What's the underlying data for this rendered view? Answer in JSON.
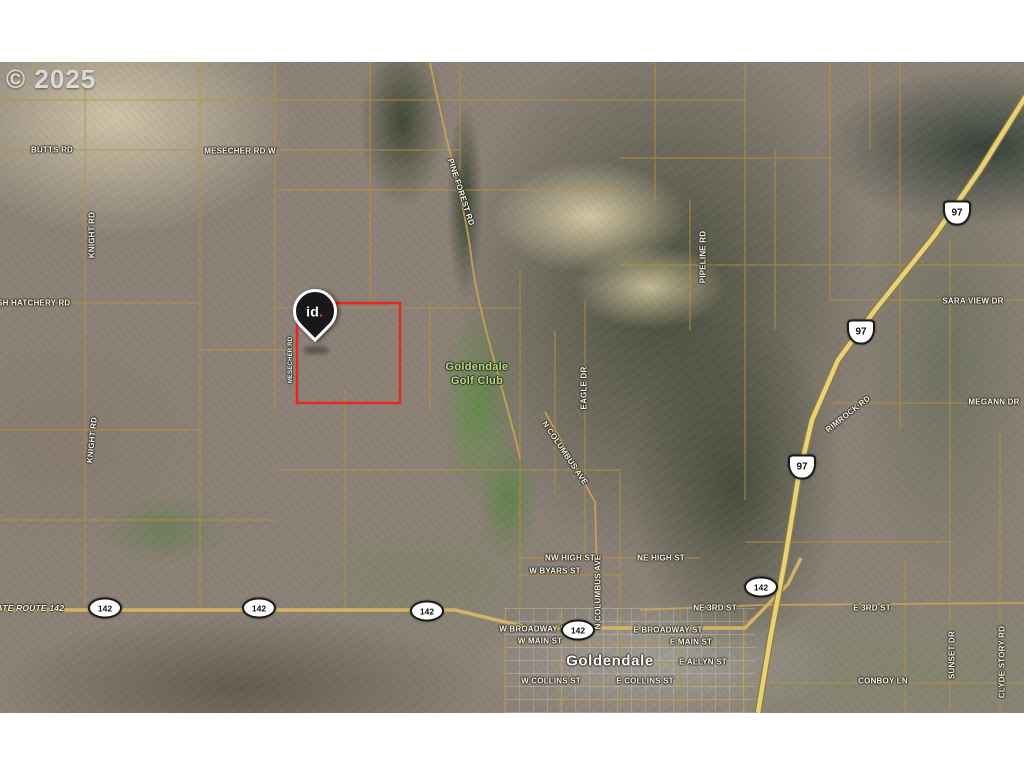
{
  "copyright": "© 2025",
  "pin": {
    "label": "id",
    "dot": "."
  },
  "colors": {
    "boundary_red": "#e8271e",
    "parcel_orange": "#bb8f40",
    "highway_yellow": "#e6d27c",
    "pin_dot_red": "#e8392e",
    "label_green": "#b6d97c"
  },
  "map": {
    "labels": [
      {
        "text": "BUTTS RD",
        "x": 52,
        "y": 88,
        "rot": 0,
        "kind": "road"
      },
      {
        "text": "MESECHER RD W",
        "x": 240,
        "y": 89,
        "rot": 0,
        "kind": "road"
      },
      {
        "text": "KNIGHT RD",
        "x": 92,
        "y": 173,
        "rot": -90,
        "kind": "road"
      },
      {
        "text": "FISH HATCHERY RD",
        "x": 30,
        "y": 241,
        "rot": 0,
        "kind": "road"
      },
      {
        "text": "KNIGHT RD",
        "x": 92,
        "y": 378,
        "rot": -84,
        "kind": "road"
      },
      {
        "text": "MESECHER RD",
        "x": 291,
        "y": 298,
        "rot": -90,
        "kind": "small"
      },
      {
        "text": "PINE FOREST RD",
        "x": 461,
        "y": 130,
        "rot": 72,
        "kind": "road"
      },
      {
        "text": "PIPELINE RD",
        "x": 703,
        "y": 195,
        "rot": -90,
        "kind": "road"
      },
      {
        "text": "SARA VIEW DR",
        "x": 973,
        "y": 239,
        "rot": 0,
        "kind": "road"
      },
      {
        "text": "MEGANN DR",
        "x": 994,
        "y": 340,
        "rot": 0,
        "kind": "road"
      },
      {
        "text": "RIMROCK RD",
        "x": 848,
        "y": 352,
        "rot": -38,
        "kind": "road"
      },
      {
        "text": "EAGLE DR",
        "x": 584,
        "y": 326,
        "rot": -90,
        "kind": "road"
      },
      {
        "text": "N COLUMBUS AVE",
        "x": 565,
        "y": 391,
        "rot": 56,
        "kind": "road"
      },
      {
        "text": "N COLUMBUS AVE",
        "x": 598,
        "y": 530,
        "rot": -90,
        "kind": "road"
      },
      {
        "text": "Goldendale",
        "x": 477,
        "y": 305,
        "rot": 0,
        "kind": "green"
      },
      {
        "text": "Golf Club",
        "x": 477,
        "y": 319,
        "rot": 0,
        "kind": "green"
      },
      {
        "text": "NW HIGH ST",
        "x": 570,
        "y": 496,
        "rot": 0,
        "kind": "road"
      },
      {
        "text": "NE HIGH ST",
        "x": 661,
        "y": 496,
        "rot": 0,
        "kind": "road"
      },
      {
        "text": "W BYARS ST",
        "x": 555,
        "y": 509,
        "rot": 0,
        "kind": "road"
      },
      {
        "text": "STATE ROUTE 142",
        "x": 25,
        "y": 546,
        "rot": 0,
        "kind": "route"
      },
      {
        "text": "W BROADWAY ST",
        "x": 535,
        "y": 567,
        "rot": 0,
        "kind": "road"
      },
      {
        "text": "E BROADWAY ST",
        "x": 668,
        "y": 568,
        "rot": 0,
        "kind": "road"
      },
      {
        "text": "W MAIN ST",
        "x": 540,
        "y": 579,
        "rot": 0,
        "kind": "road"
      },
      {
        "text": "E MAIN ST",
        "x": 691,
        "y": 580,
        "rot": 0,
        "kind": "road"
      },
      {
        "text": "NE 3RD ST",
        "x": 715,
        "y": 546,
        "rot": 0,
        "kind": "road"
      },
      {
        "text": "E 3RD ST",
        "x": 872,
        "y": 546,
        "rot": 0,
        "kind": "road"
      },
      {
        "text": "Goldendale",
        "x": 610,
        "y": 599,
        "rot": 0,
        "kind": "city"
      },
      {
        "text": "E ALLYN ST",
        "x": 703,
        "y": 600,
        "rot": 0,
        "kind": "road"
      },
      {
        "text": "W COLLINS ST",
        "x": 551,
        "y": 619,
        "rot": 0,
        "kind": "road"
      },
      {
        "text": "E COLLINS ST",
        "x": 645,
        "y": 619,
        "rot": 0,
        "kind": "road"
      },
      {
        "text": "CONBOY LN",
        "x": 883,
        "y": 619,
        "rot": 0,
        "kind": "road"
      },
      {
        "text": "SUNSET DR",
        "x": 952,
        "y": 593,
        "rot": -90,
        "kind": "road"
      },
      {
        "text": "CLYDE STORY RD",
        "x": 1002,
        "y": 600,
        "rot": -90,
        "kind": "road"
      }
    ],
    "us97_shields": [
      {
        "label": "97",
        "x": 957,
        "y": 151
      },
      {
        "label": "97",
        "x": 861,
        "y": 270
      },
      {
        "label": "97",
        "x": 802,
        "y": 405
      }
    ],
    "sr142_shields": [
      {
        "label": "142",
        "x": 105,
        "y": 546
      },
      {
        "label": "142",
        "x": 259,
        "y": 546
      },
      {
        "label": "142",
        "x": 427,
        "y": 549
      },
      {
        "label": "142",
        "x": 578,
        "y": 568
      },
      {
        "label": "142",
        "x": 761,
        "y": 525
      }
    ]
  }
}
